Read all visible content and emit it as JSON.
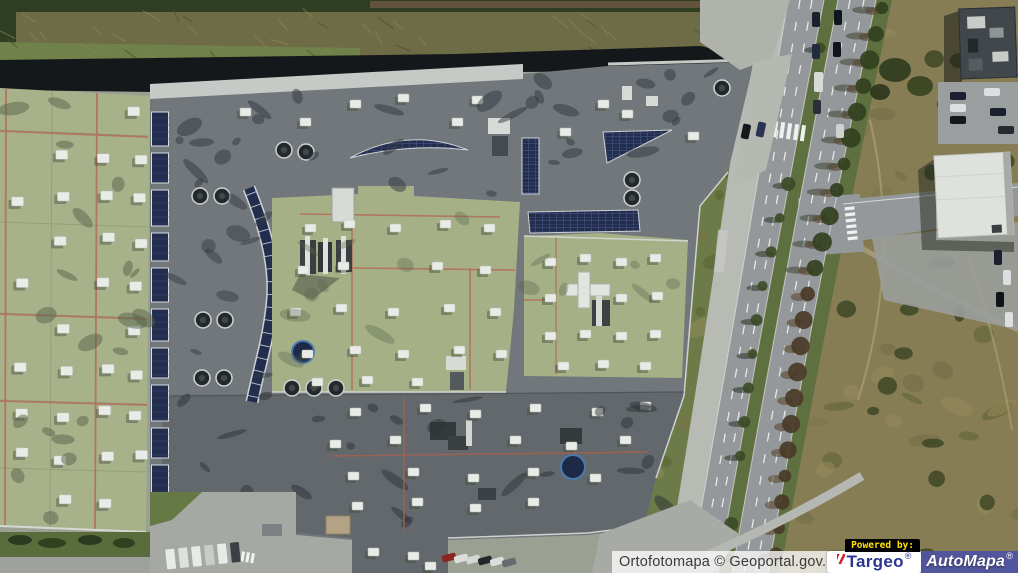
{
  "window": {
    "width": 1018,
    "height": 573
  },
  "map": {
    "kind": "aerial-orthophoto",
    "scene": "large retail warehouse complex with green and gray flat roofs, rooftop solar arrays and skylights, dual-carriageway road with tree row on the east side, scrub meadow, small outbuildings and parking lots"
  },
  "attribution": {
    "text": "Ortofotomapa © Geoportal.gov.pl"
  },
  "branding": {
    "powered_by": "Powered by:",
    "targeo": "Targeo",
    "targeo_r": "®",
    "automapa": "AutoMapa",
    "automapa_r": "®"
  },
  "palette": {
    "green_roof": "#a8b28a",
    "gray_roof": "#72777b",
    "dark_roof": "#62686c",
    "solar_panel": "#232e4e",
    "roof_walkline_red": "#b2705b",
    "parapet_white": "#c7c9c6",
    "road_asphalt": "#94989a",
    "sidewalk": "#b8bab4",
    "grass": "#6d7b48",
    "meadow": "#867d55",
    "tree_dark": "#33401f",
    "shadow": "#15181a",
    "attribution_bg": "rgba(252,252,252,0.78)",
    "attribution_text_color": "#3a3a3a",
    "powered_by_bg": "#000000",
    "powered_by_text_color": "#ffe103",
    "targeo_blue": "#2b3590",
    "targeo_red": "#d1232a",
    "automapa_bg": "rgba(62,66,148,0.88)",
    "automapa_text_color": "#ffffff"
  }
}
